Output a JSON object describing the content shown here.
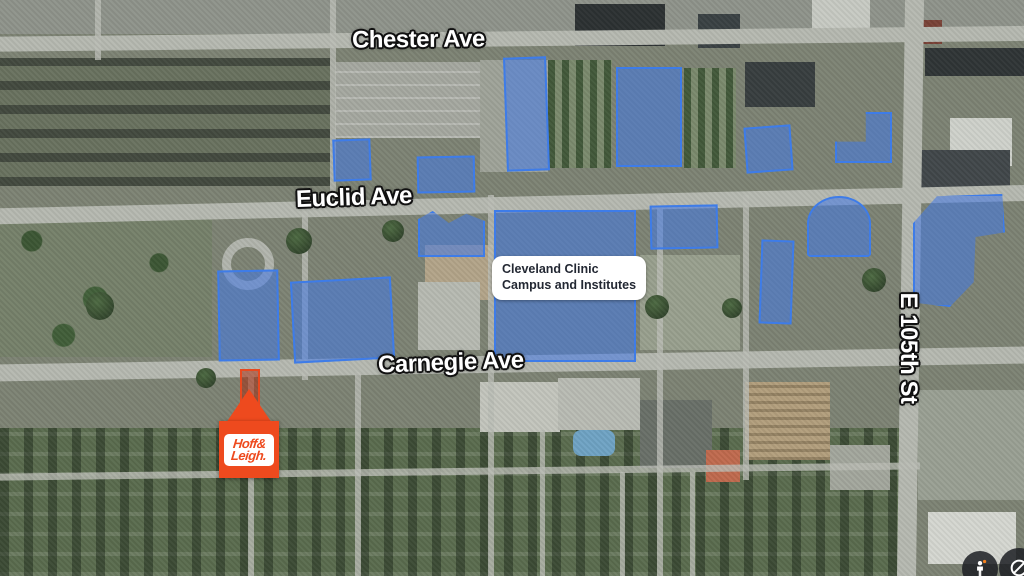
{
  "map": {
    "type": "satellite-imagery",
    "brand_color": "#ee4a1e",
    "street_labels": [
      {
        "name": "street-label-chester-ave",
        "text": "Chester Ave",
        "x": 352,
        "y": 26,
        "rot": -0.5,
        "size": 24
      },
      {
        "name": "street-label-euclid-ave",
        "text": "Euclid Ave",
        "x": 296,
        "y": 184,
        "rot": -2,
        "size": 24
      },
      {
        "name": "street-label-carnegie-ave",
        "text": "Carnegie Ave",
        "x": 378,
        "y": 349,
        "rot": -2,
        "size": 24
      },
      {
        "name": "street-label-e-105th-st",
        "text": "E 105th St",
        "x": 838,
        "y": 334,
        "rot": 90,
        "size": 24,
        "w": 140
      }
    ],
    "info_label": {
      "line1": "Cleveland Clinic",
      "line2": "Campus and Institutes"
    },
    "highlights": {
      "fill": "rgba(66,120,230,0.55)",
      "stroke": "#3e7ce8",
      "shapes": [
        {
          "x": 505,
          "y": 57,
          "w": 43,
          "h": 114,
          "rot": -2
        },
        {
          "x": 616,
          "y": 67,
          "w": 66,
          "h": 100,
          "rot": 0
        },
        {
          "x": 333,
          "y": 139,
          "w": 38,
          "h": 42,
          "rot": -2
        },
        {
          "x": 417,
          "y": 156,
          "w": 58,
          "h": 37,
          "rot": -1
        },
        {
          "x": 745,
          "y": 126,
          "w": 47,
          "h": 46,
          "rot": -4
        },
        {
          "x": 835,
          "y": 112,
          "w": 57,
          "h": 51,
          "clip": "54% 0, 100% 0, 100% 100%, 0 100%, 0 58%, 54% 58%"
        },
        {
          "x": 418,
          "y": 211,
          "w": 67,
          "h": 46,
          "clip": "0 18%, 22% 0, 46% 26%, 72% 6%, 100% 22%, 100% 100%, 0 100%"
        },
        {
          "x": 494,
          "y": 210,
          "w": 142,
          "h": 152,
          "rot": 0
        },
        {
          "x": 650,
          "y": 205,
          "w": 68,
          "h": 44,
          "rot": -1
        },
        {
          "x": 807,
          "y": 196,
          "w": 64,
          "h": 61,
          "radius": "50% 50% 6% 6% / 45% 45% 5% 5%"
        },
        {
          "x": 760,
          "y": 240,
          "w": 33,
          "h": 84,
          "rot": 2
        },
        {
          "x": 913,
          "y": 194,
          "w": 92,
          "h": 113,
          "clip": "26% 2%, 97% 0, 100% 34%, 68% 38%, 66% 78%, 40% 100%, 0 96%, 0 26%"
        },
        {
          "x": 218,
          "y": 270,
          "w": 61,
          "h": 91,
          "rot": -1
        },
        {
          "x": 292,
          "y": 279,
          "w": 101,
          "h": 82,
          "rot": -3
        }
      ]
    },
    "subject_parcel": {
      "x": 240,
      "y": 369,
      "w": 20,
      "h": 46,
      "stroke": "#e8491f",
      "fill": "rgba(170,35,5,0.5)"
    },
    "marker": {
      "line1": "Hoff&",
      "line2": "Leigh."
    },
    "controls": [
      {
        "name": "pegman-button",
        "icon": "pegman-icon"
      },
      {
        "name": "compass-button",
        "icon": "compass-icon"
      }
    ]
  }
}
